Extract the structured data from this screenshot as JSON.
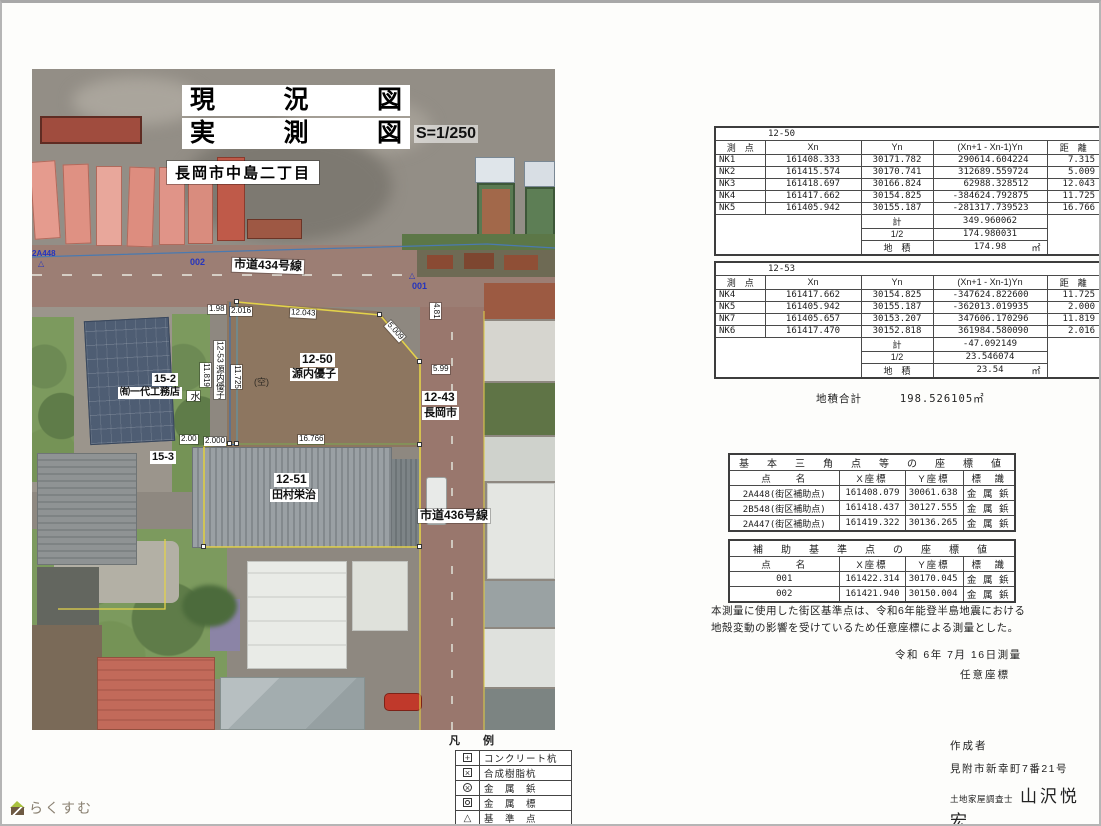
{
  "map": {
    "title_line1": "現況図",
    "title_line2": "実測図",
    "scale": "S=1/250",
    "location": "長岡市中島二丁目",
    "road434": "市道434号線",
    "road436": "市道436号線",
    "p1250_no": "12-50",
    "p1250_owner": "源内優子",
    "p1243_no": "12-43",
    "p1243_owner": "長岡市",
    "p1251_no": "12-51",
    "p1251_owner": "田村栄治",
    "p152_no": "15-2",
    "p152_owner": "㈲一代工務店",
    "p153_no": "15-3",
    "p1253_vertical": "12-53 源内優子",
    "water": "水",
    "vacant": "(空)",
    "pt001": "001",
    "pt002": "002",
    "pt2a448": "2A448",
    "meas": {
      "top": "12.043",
      "diag": "5.009",
      "left_a": "11.819",
      "left_b": "11.725",
      "bottom": "16.766",
      "road_w": "4.81",
      "right": "5.99",
      "b1": "2.00",
      "b2": "2.000",
      "t1": "1.98",
      "t2": "2.016"
    }
  },
  "legend": {
    "title": "凡　例",
    "items": [
      {
        "label": "コンクリート杭"
      },
      {
        "label": "合成樹脂杭"
      },
      {
        "label": "金　属　鋲"
      },
      {
        "label": "金　属　標"
      },
      {
        "label": "基　準　点"
      }
    ]
  },
  "tables": {
    "t1": {
      "id": "12-50",
      "headers": [
        "測　点",
        "Xn",
        "Yn",
        "(Xn+1 - Xn-1)Yn",
        "距　離"
      ],
      "rows": [
        [
          "NK1",
          "161408.333",
          "30171.782",
          "290614.604224",
          "7.315"
        ],
        [
          "NK2",
          "161415.574",
          "30170.741",
          "312689.559724",
          "5.009"
        ],
        [
          "NK3",
          "161418.697",
          "30166.824",
          "62988.328512",
          "12.043"
        ],
        [
          "NK4",
          "161417.662",
          "30154.825",
          "-384624.792875",
          "11.725"
        ],
        [
          "NK5",
          "161405.942",
          "30155.187",
          "-281317.739523",
          "16.766"
        ]
      ],
      "footer": [
        {
          "label": "計",
          "value": "349.960062",
          "unit": ""
        },
        {
          "label": "1/2",
          "value": "174.980031",
          "unit": ""
        },
        {
          "label": "地　積",
          "value": "174.98",
          "unit": "㎡"
        }
      ]
    },
    "t2": {
      "id": "12-53",
      "headers": [
        "測　点",
        "Xn",
        "Yn",
        "(Xn+1 - Xn-1)Yn",
        "距　離"
      ],
      "rows": [
        [
          "NK4",
          "161417.662",
          "30154.825",
          "-347624.822600",
          "11.725"
        ],
        [
          "NK5",
          "161405.942",
          "30155.187",
          "-362013.019935",
          "2.000"
        ],
        [
          "NK7",
          "161405.657",
          "30153.207",
          "347606.170296",
          "11.819"
        ],
        [
          "NK6",
          "161417.470",
          "30152.818",
          "361984.580090",
          "2.016"
        ]
      ],
      "footer": [
        {
          "label": "計",
          "value": "-47.092149",
          "unit": ""
        },
        {
          "label": "1/2",
          "value": "23.546074",
          "unit": ""
        },
        {
          "label": "地　積",
          "value": "23.54",
          "unit": "㎡"
        }
      ]
    }
  },
  "area_total": {
    "label": "地積合計",
    "value": "198.526105㎡"
  },
  "coord1": {
    "title": "基　本　三　角　点　等　の　座　標　値",
    "headers": [
      "点　　名",
      "X座標",
      "Y座標",
      "標　識"
    ],
    "rows": [
      [
        "2A448(街区補助点)",
        "161408.079",
        "30061.638",
        "金 属 鋲"
      ],
      [
        "2B548(街区補助点)",
        "161418.437",
        "30127.555",
        "金 属 鋲"
      ],
      [
        "2A447(街区補助点)",
        "161419.322",
        "30136.265",
        "金 属 鋲"
      ]
    ]
  },
  "coord2": {
    "title": "補　助　基　準　点　の　座　標　値",
    "headers": [
      "点　　名",
      "X座標",
      "Y座標",
      "標　識"
    ],
    "rows": [
      [
        "001",
        "161422.314",
        "30170.045",
        "金 属 鋲"
      ],
      [
        "002",
        "161421.940",
        "30150.004",
        "金 属 鋲"
      ]
    ]
  },
  "note": {
    "line1": "本測量に使用した街区基準点は、令和6年能登半島地震における",
    "line2": "地殻変動の影響を受けているため任意座標による測量とした。"
  },
  "survey_date": "令和 6年 7月 16日測量",
  "coord_system": "任意座標",
  "author": {
    "heading": "作成者",
    "address": "見附市新幸町7番21号",
    "role": "土地家屋調査士",
    "name": "山沢悦宏"
  },
  "logo_text": "らくすむ"
}
